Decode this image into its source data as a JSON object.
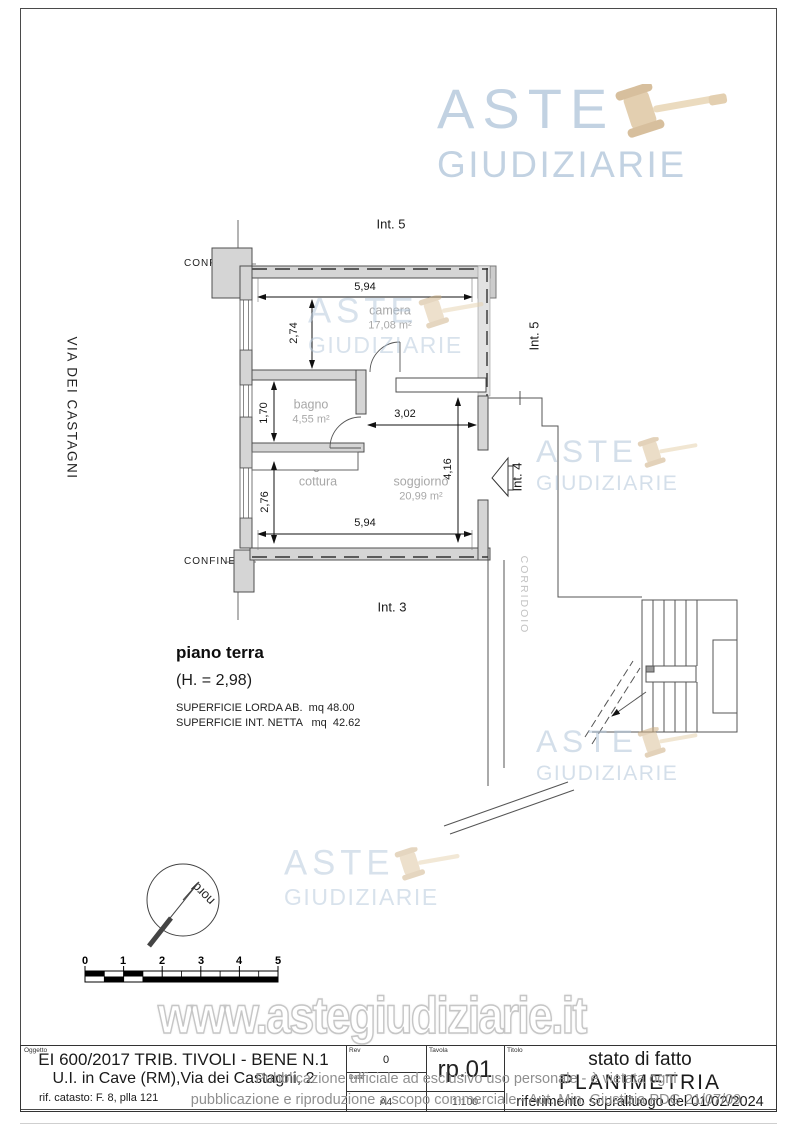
{
  "page": {
    "watermark_url": "www.astegiudiziarie.it",
    "logo": {
      "line1": "ASTE",
      "line2": "GIUDIZIARIE"
    },
    "disclaimer_line1": "Pubblicazione ufficiale ad esclusivo uso personale - è vietata ogni",
    "disclaimer_line2": "pubblicazione e riproduzione a scopo commerciale - Aut. Min. Giustizia PDG 21/07/09"
  },
  "plan": {
    "street": "VIA DEI CASTAGNI",
    "labels": {
      "int5_top": "Int. 5",
      "int5_right": "Int. 5",
      "int4": "Int. 4",
      "int3": "Int. 3",
      "confine_top": "CONFINE",
      "confine_bottom": "CONFINE",
      "corridoio": "CORRIDOIO",
      "nord": "nord"
    },
    "rooms": [
      {
        "name": "camera",
        "area": "17,08 m²"
      },
      {
        "name": "bagno",
        "area": "4,55 m²"
      },
      {
        "name": "angolo cottura",
        "area": ""
      },
      {
        "name": "soggiorno",
        "area": "20,99 m²"
      }
    ],
    "dimensions": {
      "top_width": "5,94",
      "camera_height": "2,74",
      "bagno_height": "1,70",
      "cottura_height": "2,76",
      "soggiorno_width": "3,02",
      "soggiorno_height": "4,16",
      "bottom_width": "5,94"
    },
    "floor": {
      "title": "piano terra",
      "height": "(H. = 2,98)",
      "surface_line1": "SUPERFICIE LORDA AB.  mq 48.00",
      "surface_line2": "SUPERFICIE INT. NETTA   mq  42.62"
    },
    "scalebar": {
      "ticks": [
        "0",
        "1",
        "2",
        "3",
        "4",
        "5"
      ]
    }
  },
  "titleblock": {
    "oggetto_label": "Oggetto",
    "oggetto_line1": "EI 600/2017 TRIB. TIVOLI - BENE N.1",
    "oggetto_line2": "U.I. in Cave (RM),Via dei Castagni, 2",
    "oggetto_line3": "rif. catasto:  F. 8, plla 121",
    "rev_label": "Rev",
    "rev_value": "0",
    "data_label": "Data",
    "formato_value": "A4",
    "tavola_label": "Tavola",
    "tavola_value": "rp.01",
    "scala_value": "1:100",
    "titolo_label": "Titolo",
    "titolo_line1": "stato di fatto",
    "titolo_line2": "PLANIMETRIA",
    "titolo_line3": "riferimento sopralluogo del 01/02/2024"
  }
}
